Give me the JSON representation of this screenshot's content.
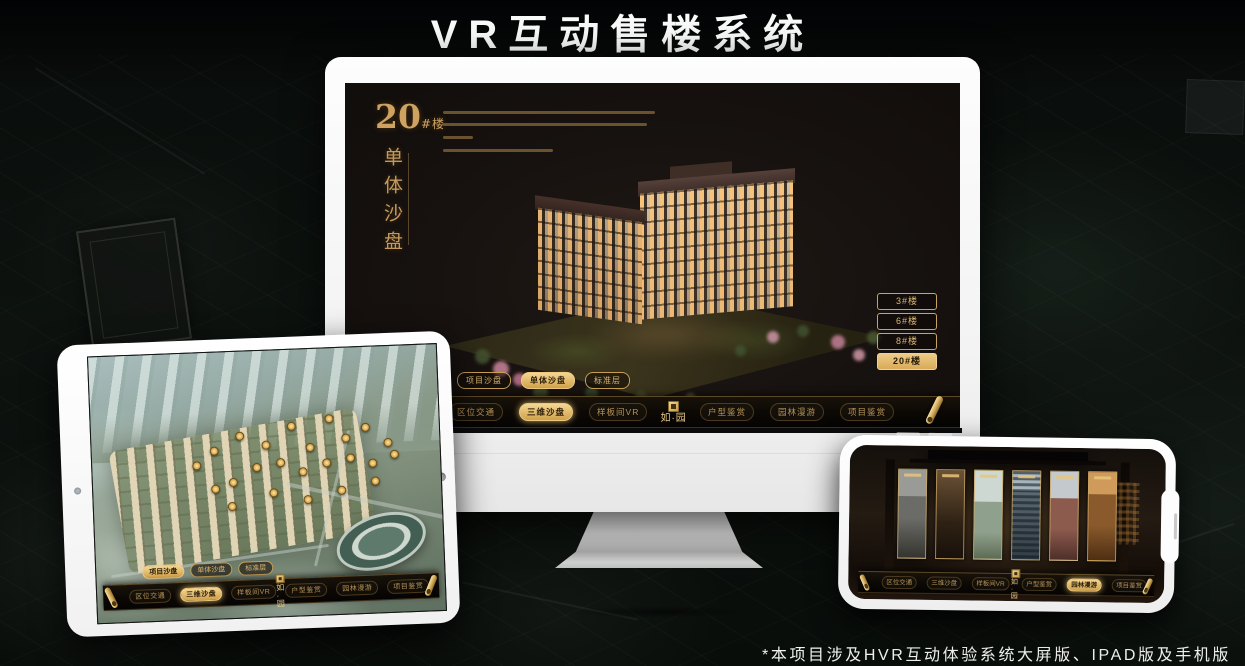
{
  "page": {
    "title": "VR互动售楼系统",
    "footnote": "*本项目涉及HVR互动体验系统大屏版、IPAD版及手机版"
  },
  "colors": {
    "gold": "#cfa24f",
    "gold_bright": "#f2d694",
    "screen_dark": "#171210",
    "frame_white": "#fafafa"
  },
  "icons": {
    "scroll": "gold-rolled-scroll",
    "seal": "gold-square-seal",
    "camera": "front-camera-dot",
    "home": "home-button",
    "speaker": "earpiece-slit"
  },
  "monitor_app": {
    "hero": {
      "building_no": "20",
      "building_suffix": "#楼",
      "subtitle_vertical": "单体沙盘"
    },
    "floor_buttons": [
      {
        "label": "3#楼",
        "selected": false
      },
      {
        "label": "6#楼",
        "selected": false
      },
      {
        "label": "8#楼",
        "selected": false
      },
      {
        "label": "20#楼",
        "selected": true
      }
    ],
    "mode_tabs": [
      {
        "label": "项目沙盘",
        "selected": false
      },
      {
        "label": "单体沙盘",
        "selected": true
      },
      {
        "label": "标准层",
        "selected": false
      }
    ],
    "nav": {
      "logo_text": "如·园",
      "items": [
        {
          "label": "区位交通",
          "selected": false
        },
        {
          "label": "三维沙盘",
          "selected": true
        },
        {
          "label": "样板间VR",
          "selected": false
        },
        {
          "label": "户型鉴赏",
          "selected": false
        },
        {
          "label": "园林漫游",
          "selected": false
        },
        {
          "label": "项目鉴赏",
          "selected": false
        }
      ]
    }
  },
  "tablet_app": {
    "mode_tabs": [
      {
        "label": "项目沙盘",
        "selected": true
      },
      {
        "label": "单体沙盘",
        "selected": false
      },
      {
        "label": "标准层",
        "selected": false
      }
    ],
    "nav": {
      "logo_text": "如·园",
      "items": [
        {
          "label": "区位交通",
          "selected": false
        },
        {
          "label": "三维沙盘",
          "selected": true
        },
        {
          "label": "样板间VR",
          "selected": false
        },
        {
          "label": "户型鉴赏",
          "selected": false
        },
        {
          "label": "园林漫游",
          "selected": false
        },
        {
          "label": "项目鉴赏",
          "selected": false
        }
      ]
    }
  },
  "phone_app": {
    "nav": {
      "logo_text": "如·园",
      "items": [
        {
          "label": "区位交通",
          "selected": false
        },
        {
          "label": "三维沙盘",
          "selected": false
        },
        {
          "label": "样板间VR",
          "selected": false
        },
        {
          "label": "户型鉴赏",
          "selected": false
        },
        {
          "label": "园林漫游",
          "selected": true
        },
        {
          "label": "项目鉴赏",
          "selected": false
        }
      ]
    }
  }
}
